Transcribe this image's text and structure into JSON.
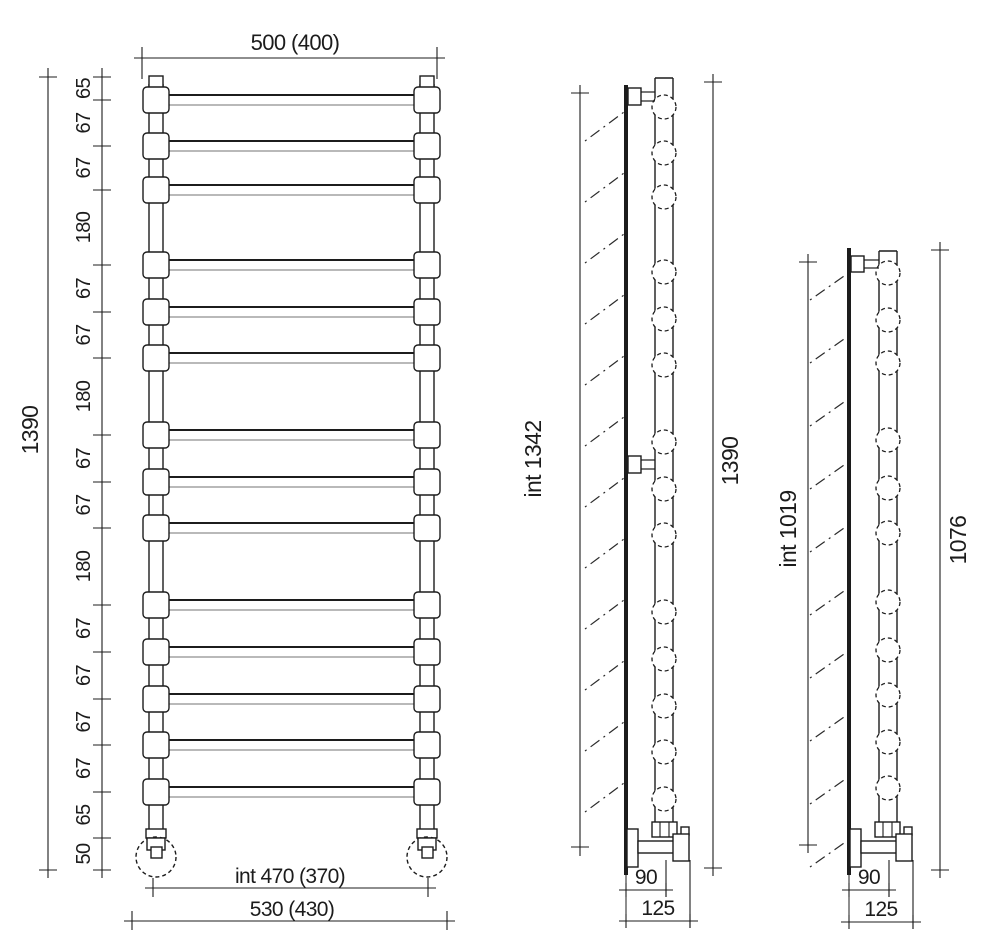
{
  "drawing_title": "towel-radiator-dimension-drawing",
  "front_view": {
    "width_label": "500 (400)",
    "total_height_label": "1390",
    "segment_labels": [
      "65",
      "67",
      "67",
      "180",
      "67",
      "67",
      "180",
      "67",
      "67",
      "180",
      "67",
      "67",
      "67",
      "67",
      "65",
      "50"
    ],
    "inner_width_label": "int 470 (370)",
    "outer_width_label": "530 (430)"
  },
  "side_view_tall": {
    "internal_height_label": "int 1342",
    "total_height_label": "1390",
    "wall_to_axis_label": "90",
    "overall_depth_label": "125"
  },
  "side_view_short": {
    "internal_height_label": "int 1019",
    "total_height_label": "1076",
    "wall_to_axis_label": "90",
    "overall_depth_label": "125"
  }
}
